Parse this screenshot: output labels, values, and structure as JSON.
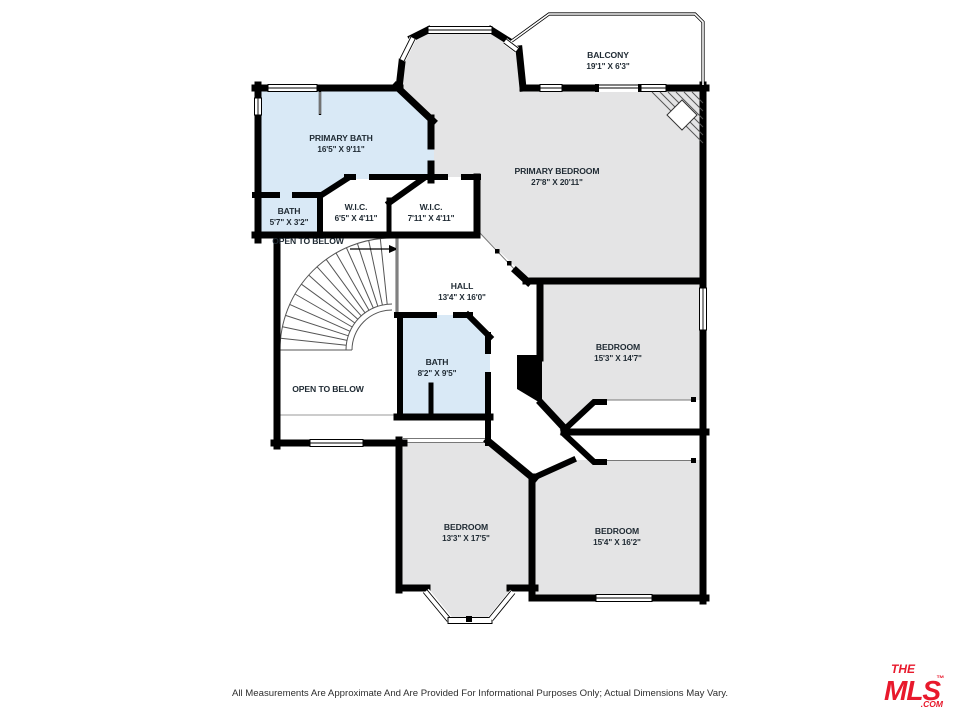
{
  "floor_plan": {
    "labels": {
      "balcony": {
        "name": "BALCONY",
        "dims": "19'1\" X 6'3\""
      },
      "primary_bath": {
        "name": "PRIMARY BATH",
        "dims": "16'5\" X 9'11\""
      },
      "primary_bedroom": {
        "name": "PRIMARY BEDROOM",
        "dims": "27'8\" X 20'11\""
      },
      "bath_small": {
        "name": "BATH",
        "dims": "5'7\" X 3'2\""
      },
      "wic_left": {
        "name": "W.I.C.",
        "dims": "6'5\" X 4'11\""
      },
      "wic_right": {
        "name": "W.I.C.",
        "dims": "7'11\" X 4'11\""
      },
      "open_to_below_upper": {
        "name": "OPEN TO BELOW"
      },
      "hall": {
        "name": "HALL",
        "dims": "13'4\" X 16'0\""
      },
      "bath_center": {
        "name": "BATH",
        "dims": "8'2\" X 9'5\""
      },
      "bedroom_right": {
        "name": "BEDROOM",
        "dims": "15'3\" X 14'7\""
      },
      "open_to_below_lower": {
        "name": "OPEN TO BELOW"
      },
      "bedroom_bottom_left": {
        "name": "BEDROOM",
        "dims": "13'3\" X 17'5\""
      },
      "bedroom_bottom_right": {
        "name": "BEDROOM",
        "dims": "15'4\" X 16'2\""
      }
    },
    "colors": {
      "wall": "#000000",
      "bath_fill": "#d9e9f6",
      "bedroom_fill": "#e4e4e5",
      "label_text": "#1f2a33"
    }
  },
  "footer": {
    "disclaimer": "All Measurements Are Approximate And Are Provided For Informational Purposes Only; Actual Dimensions May Vary."
  },
  "logo": {
    "the": "THE",
    "mls": "MLS",
    "tm": "™",
    "com": ".COM",
    "color": "#e8192c"
  }
}
